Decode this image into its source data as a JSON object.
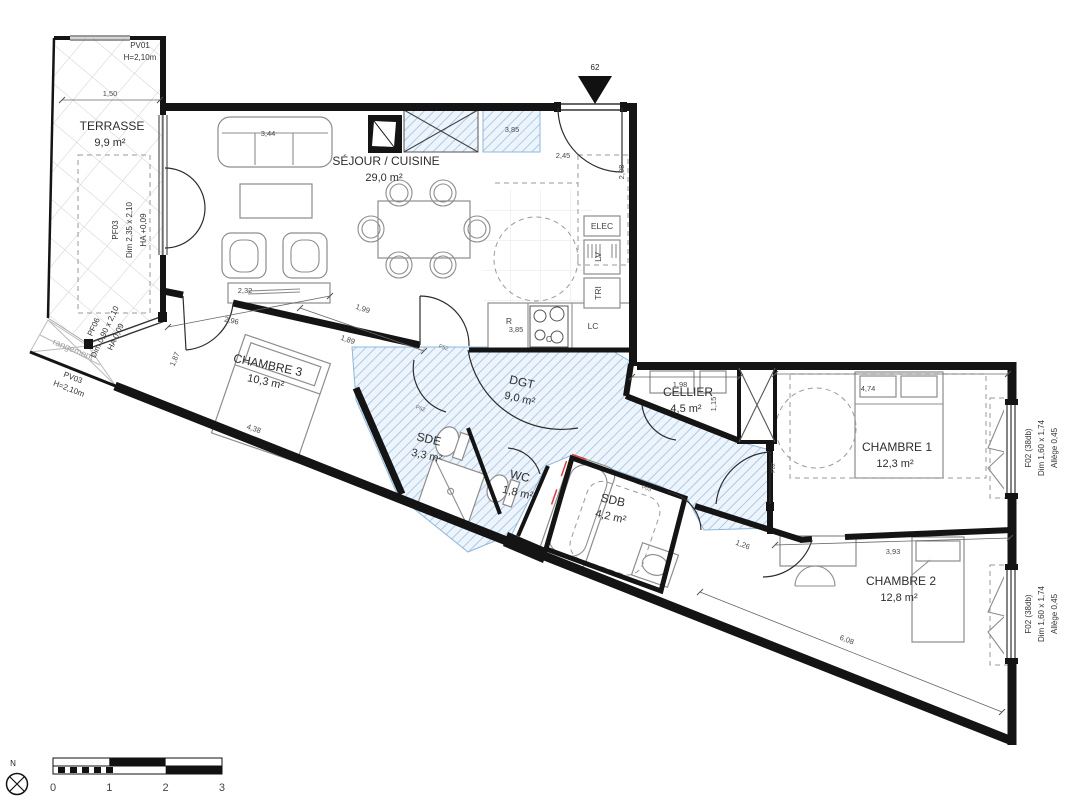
{
  "plan": {
    "entrance_number": "62",
    "north_label": "N"
  },
  "scale_bar": {
    "ticks": [
      "0",
      "1",
      "2",
      "3"
    ]
  },
  "rooms": [
    {
      "id": "terrasse",
      "name": "TERRASSE",
      "area": "9,9 m²",
      "x": 112,
      "y": 130,
      "rot": 0
    },
    {
      "id": "sejour-cuisine",
      "name": "SÉJOUR / CUISINE",
      "area": "29,0 m²",
      "x": 386,
      "y": 165,
      "rot": 0
    },
    {
      "id": "chambre-3",
      "name": "CHAMBRE 3",
      "area": "10,3 m²",
      "x": 267,
      "y": 369,
      "rot": 12
    },
    {
      "id": "dgt",
      "name": "DGT",
      "area": "9,0 m²",
      "x": 521,
      "y": 386,
      "rot": 13
    },
    {
      "id": "sde",
      "name": "SDE",
      "area": "3,3 m²",
      "x": 428,
      "y": 443,
      "rot": 13
    },
    {
      "id": "wc",
      "name": "WC",
      "area": "1,8 m²",
      "x": 519,
      "y": 480,
      "rot": 13
    },
    {
      "id": "sdb",
      "name": "SDB",
      "area": "4,2 m²",
      "x": 612,
      "y": 504,
      "rot": 13
    },
    {
      "id": "cellier",
      "name": "CELLIER",
      "area": "4,5 m²",
      "x": 688,
      "y": 396,
      "rot": 0
    },
    {
      "id": "chambre-1",
      "name": "CHAMBRE 1",
      "area": "12,3 m²",
      "x": 897,
      "y": 451,
      "rot": 0
    },
    {
      "id": "chambre-2",
      "name": "CHAMBRE 2",
      "area": "12,8 m²",
      "x": 901,
      "y": 585,
      "rot": 0
    },
    {
      "id": "rangement",
      "name": "rangement",
      "area": "",
      "x": 72,
      "y": 352,
      "rot": 22,
      "muted": true
    }
  ],
  "window_labels": [
    {
      "id": "pv01",
      "lines": [
        "PV01",
        "H=2,10m"
      ],
      "x": 140,
      "y": 48,
      "rot": 0,
      "line_dx": 0,
      "line_dy": 12
    },
    {
      "id": "pf03",
      "lines": [
        "PF03",
        "Dim  2,35 x 2,10",
        "HA  +0,09"
      ],
      "x": 118,
      "y": 230,
      "rot": -90,
      "line_dx": 14,
      "line_dy": 0
    },
    {
      "id": "pf06",
      "lines": [
        "PF06",
        "Dim  0,90 x 2,10",
        "HA  0,09"
      ],
      "x": 96,
      "y": 328,
      "rot": -65,
      "line_dx": 11,
      "line_dy": 5
    },
    {
      "id": "pv03",
      "lines": [
        "PV03",
        "H=2,10m"
      ],
      "x": 72,
      "y": 380,
      "rot": 21,
      "line_dx": -4,
      "line_dy": 11
    },
    {
      "id": "f02-chambre1",
      "lines": [
        "F02 (38db)",
        "Dim   1,60 x 1,74",
        "Allège  0,45"
      ],
      "x": 1031,
      "y": 448,
      "rot": -90,
      "line_dx": 13,
      "line_dy": 0
    },
    {
      "id": "f02-chambre2",
      "lines": [
        "F02 (38db)",
        "Dim   1,60 x 1,74",
        "Allège  0,45"
      ],
      "x": 1031,
      "y": 614,
      "rot": -90,
      "line_dx": 13,
      "line_dy": 0
    }
  ],
  "equipment": [
    {
      "text": "ELEC",
      "x": 602,
      "y": 229,
      "rot": 0
    },
    {
      "text": "LV",
      "x": 601,
      "y": 257,
      "rot": -90
    },
    {
      "text": "TRI",
      "x": 601,
      "y": 293,
      "rot": -90
    },
    {
      "text": "R",
      "x": 509,
      "y": 324,
      "rot": 0
    },
    {
      "text": "C",
      "x": 549,
      "y": 342,
      "rot": 0
    },
    {
      "text": "LC",
      "x": 593,
      "y": 329,
      "rot": 0
    }
  ],
  "dimensions": [
    {
      "text": "1,50",
      "x": 110,
      "y": 96,
      "rot": 0
    },
    {
      "text": "3,44",
      "x": 268,
      "y": 136,
      "rot": 0
    },
    {
      "text": "2,32",
      "x": 245,
      "y": 293,
      "rot": 0
    },
    {
      "text": "3,85",
      "x": 512,
      "y": 132,
      "rot": 0
    },
    {
      "text": "2,45",
      "x": 563,
      "y": 158,
      "rot": 0
    },
    {
      "text": "2,08",
      "x": 624,
      "y": 172,
      "rot": -90
    },
    {
      "text": "3,85",
      "x": 516,
      "y": 332,
      "rot": 0
    },
    {
      "text": "1,99",
      "x": 362,
      "y": 311,
      "rot": 19
    },
    {
      "text": "1,89",
      "x": 347,
      "y": 342,
      "rot": 19
    },
    {
      "text": "2,96",
      "x": 231,
      "y": 323,
      "rot": 13
    },
    {
      "text": "1,87",
      "x": 177,
      "y": 360,
      "rot": -68
    },
    {
      "text": "4,38",
      "x": 253,
      "y": 431,
      "rot": 19
    },
    {
      "text": "1,98",
      "x": 680,
      "y": 387,
      "rot": 0
    },
    {
      "text": "1,15",
      "x": 716,
      "y": 404,
      "rot": -90
    },
    {
      "text": "4,74",
      "x": 868,
      "y": 391,
      "rot": 0
    },
    {
      "text": "3,93",
      "x": 893,
      "y": 554,
      "rot": 0
    },
    {
      "text": "6,08",
      "x": 846,
      "y": 642,
      "rot": 21
    },
    {
      "text": "1,26",
      "x": 742,
      "y": 547,
      "rot": 21
    }
  ],
  "door_tags": [
    {
      "text": "P52",
      "x": 443,
      "y": 349,
      "rot": 19
    },
    {
      "text": "P62",
      "x": 420,
      "y": 410,
      "rot": 19
    },
    {
      "text": "P03",
      "x": 646,
      "y": 490,
      "rot": 19
    },
    {
      "text": "P02",
      "x": 775,
      "y": 468,
      "rot": -90
    }
  ],
  "colors": {
    "wall": "#141414",
    "hatch_blue_line": "#a6c6e5",
    "hatch_blue_bg": "#edf4fb",
    "hatch_blue_border": "#8fb8dc",
    "furniture": "#8d8d8d",
    "dashed": "#9a9a9a",
    "red_accent": "#e03a3a",
    "terrace_grid": "#cfcfcf"
  }
}
